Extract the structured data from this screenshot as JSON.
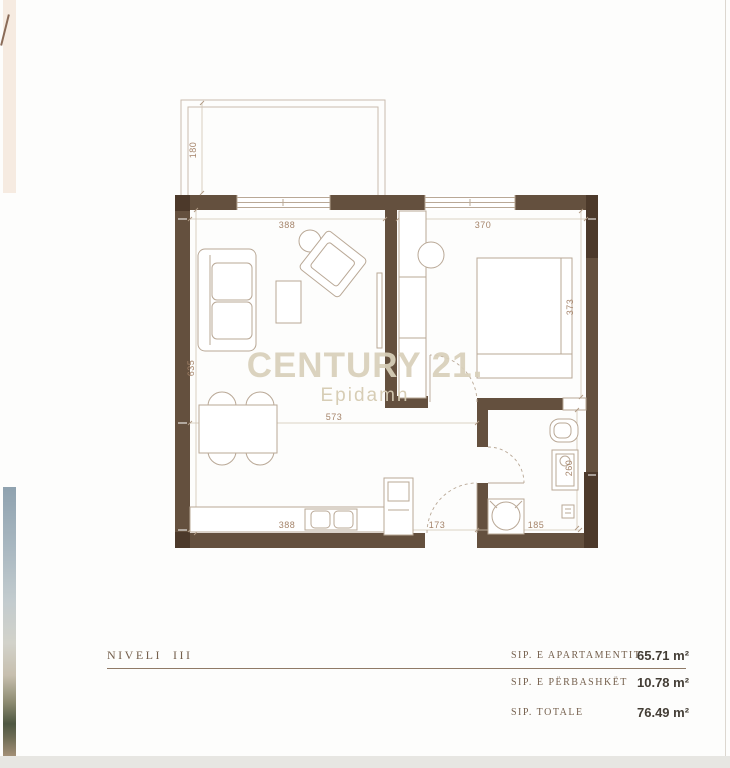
{
  "watermark": {
    "brand": "CENTURY 21.",
    "subbrand": "Epidamn"
  },
  "plan": {
    "dims": {
      "living_width_top": "388",
      "bedroom_width_top": "370",
      "balcony_depth": "180",
      "left_height": "635",
      "bedroom_height": "373",
      "living_width_mid": "573",
      "kitchen_width_bottom": "388",
      "hall_width_bottom": "173",
      "bath_width_bottom": "185",
      "bath_height": "260"
    },
    "colors": {
      "wall": "#64503e",
      "wall_dark": "#4c392a",
      "furniture_line": "#b9a896",
      "dimension_line": "#d0c3b2",
      "dimension_text": "#a5846a",
      "watermark": "#d9d0ba"
    }
  },
  "legend": {
    "level_label": "NIVELI  III",
    "rows": [
      {
        "label": "SIP. E APARTAMENTIT",
        "value": "65.71 m²"
      },
      {
        "label": "SIP. E PËRBASHKËT",
        "value": "10.78 m²"
      },
      {
        "label": "SIP. TOTALE",
        "value": "76.49 m²"
      }
    ]
  }
}
